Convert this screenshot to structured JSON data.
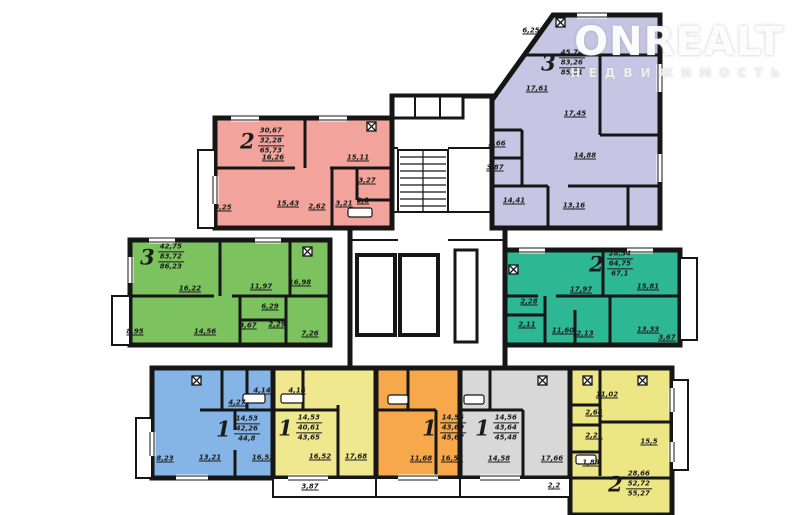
{
  "watermark": {
    "brand": "ONREALT",
    "subtitle": "НЕДВИЖИМОСТЬ"
  },
  "colors": {
    "wall": "#161616",
    "pink": "#f2a39c",
    "purple": "#c8c5e4",
    "green": "#7cc25e",
    "teal": "#2db795",
    "blue": "#85b5e6",
    "yellow": "#efe88f",
    "orange": "#f7a84b",
    "gray": "#d8d8d8",
    "yellow_right": "#ece784"
  },
  "apartments": [
    {
      "key": "pink",
      "type": "2",
      "area_values": [
        "30,67",
        "32,28",
        "65,73"
      ],
      "room_areas": [
        "16,26",
        "15,11",
        "3,27",
        "15,43",
        "2,62",
        "3,21",
        "2,1",
        "8,25"
      ]
    },
    {
      "key": "purple",
      "type": "3",
      "area_values": [
        "45,74",
        "83,26",
        "85,81"
      ],
      "room_areas": [
        "6,25",
        "17,61",
        "17,45",
        "14,88",
        "2,66",
        "3,87",
        "14,41",
        "13,16"
      ]
    },
    {
      "key": "green",
      "type": "3",
      "area_values": [
        "42,75",
        "83,72",
        "86,23"
      ],
      "room_areas": [
        "16,22",
        "11,97",
        "16,98",
        "14,56",
        "3,67",
        "2,29",
        "6,29",
        "7,26",
        "8,95"
      ]
    },
    {
      "key": "teal",
      "type": "2",
      "area_values": [
        "28,34",
        "64,75",
        "67,1"
      ],
      "room_areas": [
        "17,97",
        "15,81",
        "2,28",
        "2,11",
        "11,60",
        "2,13",
        "13,33",
        "3,67"
      ]
    },
    {
      "key": "blue",
      "type": "1",
      "area_values": [
        "14,53",
        "42,26",
        "44,8"
      ],
      "room_areas": [
        "4,27",
        "4,14",
        "13,21",
        "16,52",
        "8,23"
      ]
    },
    {
      "key": "yellow",
      "type": "1",
      "area_values": [
        "14,53",
        "40,61",
        "43,65"
      ],
      "room_areas": [
        "4,16",
        "16,52",
        "17,68"
      ]
    },
    {
      "key": "orange",
      "type": "1",
      "area_values": [
        "14,56",
        "43,69",
        "45,67"
      ],
      "room_areas": [
        "11,68",
        "16,56"
      ]
    },
    {
      "key": "gray",
      "type": "1",
      "area_values": [
        "14,56",
        "43,64",
        "45,48"
      ],
      "room_areas": [
        "14,58",
        "17,66",
        "2,2"
      ]
    },
    {
      "key": "yellow_right",
      "type": "2",
      "area_values": [
        "28,66",
        "52,72",
        "55,27"
      ],
      "room_areas": [
        "11,02",
        "2,64",
        "2,21",
        "1,89",
        "15,5"
      ]
    }
  ],
  "common_labels": {
    "balcony": "3,87"
  }
}
